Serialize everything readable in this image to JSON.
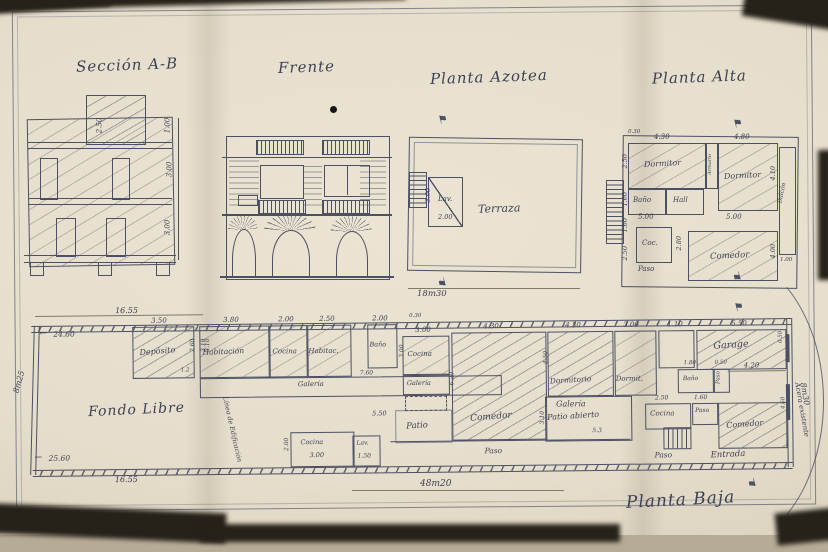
{
  "icons": {
    "arrow_left": "←",
    "flag": "⚑"
  },
  "titles": {
    "seccion": "Sección A-B",
    "frente": "Frente",
    "azotea": "Planta Azotea",
    "alta": "Planta Alta",
    "baja": "Planta Baja"
  },
  "seccion": {
    "dims": {
      "tower": "2.50",
      "parapet": "1.00",
      "upper_floor": "3.00",
      "lower_floor": "3.00"
    }
  },
  "azotea": {
    "rooms": {
      "terraza": "Terraza",
      "lav": "Lav."
    },
    "dims": {
      "lav_depth": "3.00",
      "lav_width": "2.00",
      "overall": "18m30"
    }
  },
  "alta": {
    "rooms": {
      "dorm1": "Dormitor",
      "dorm2": "Dormitor",
      "armario": "Armario",
      "bano": "Baño",
      "hall": "Hall",
      "coc": "Coc.",
      "paso": "Paso",
      "comedor": "Comedor",
      "balcon": "Balcón"
    },
    "dims": {
      "small_top": "0.30",
      "dorm1_w": "4.30",
      "dorm2_w": "4.80",
      "left_top": "2.50",
      "bano_h": "1.60",
      "left_mid": "1.60",
      "left_low": "2.50",
      "dorm2_h": "4.10",
      "row1": "5.00",
      "row2": "5.00",
      "coc_h": "2.80",
      "comedor_h": "4.00",
      "balcon_w": "1.00"
    }
  },
  "baja": {
    "rooms": {
      "fondo": "Fondo Libre",
      "deposito": "Depósito",
      "habitacion": "Habitación",
      "cocina1": "Cocina",
      "habitac": "Habitac.",
      "bano1": "Baño",
      "galeria1": "Galería",
      "cocina_ext": "Cocina",
      "lav_ext": "Lav.",
      "cocina2": "Cocina",
      "galeria2": "Galería",
      "comedor1": "Comedor",
      "patio": "Patio",
      "paso_main": "Paso",
      "dormitorio": "Dormitorio",
      "galeria3": "Galería",
      "patio_abierto": "Patio abierto",
      "dormit2": "Dormit.",
      "garage": "Garage",
      "bano2": "Baño",
      "paso2": "Paso",
      "cocina3": "Cocina",
      "paso3": "Paso",
      "paso4": "Paso",
      "comedor2": "Comedor",
      "entrada": "Entrada"
    },
    "dims": {
      "top_left": "16.55",
      "bottom_left": "16.55",
      "offset_top": "24.60",
      "offset_bottom": "25.60",
      "deposito_w": "3.50",
      "deposito_d": "2.60",
      "gap_d": "3.10",
      "deposito_door": "1.2",
      "habitacion_w": "3.80",
      "habitacion_d": "3.10",
      "cocina1_w": "2.00",
      "habitac_w": "2.50",
      "bano1_w": "2.00",
      "galeria1_l": "7.60",
      "cocina_ext_w": "3.00",
      "cocina_ext_d": "2.00",
      "lav_ext_w": "1.50",
      "mid": "5.50",
      "small_top": "0.30",
      "cocina2_w": "3.00",
      "cocina2_d": "3.00",
      "comedor1_w": "4.30",
      "comedor1_d": "6.20",
      "dormitorio_w": "4.30",
      "dormitorio_d": "4.50",
      "galeria3_w": "5.3",
      "galeria3_d": "3.10",
      "dormit2_w": "3.00",
      "front_gap": "1.10",
      "garage_w": "5.50",
      "garage_d": "0.50",
      "bano2_w": "1.80",
      "paso2_w": "0.50",
      "cocina3_w": "2.50",
      "paso3_w": "1.60",
      "comedor2_w": "4.20",
      "comedor2_d": "4.60",
      "lot_length": "48m20",
      "lot_width_rear": "8m25",
      "lot_width_front": "8m30"
    },
    "annotations": {
      "linea": "Línea de Edificación",
      "acera": "Acera existente"
    }
  }
}
